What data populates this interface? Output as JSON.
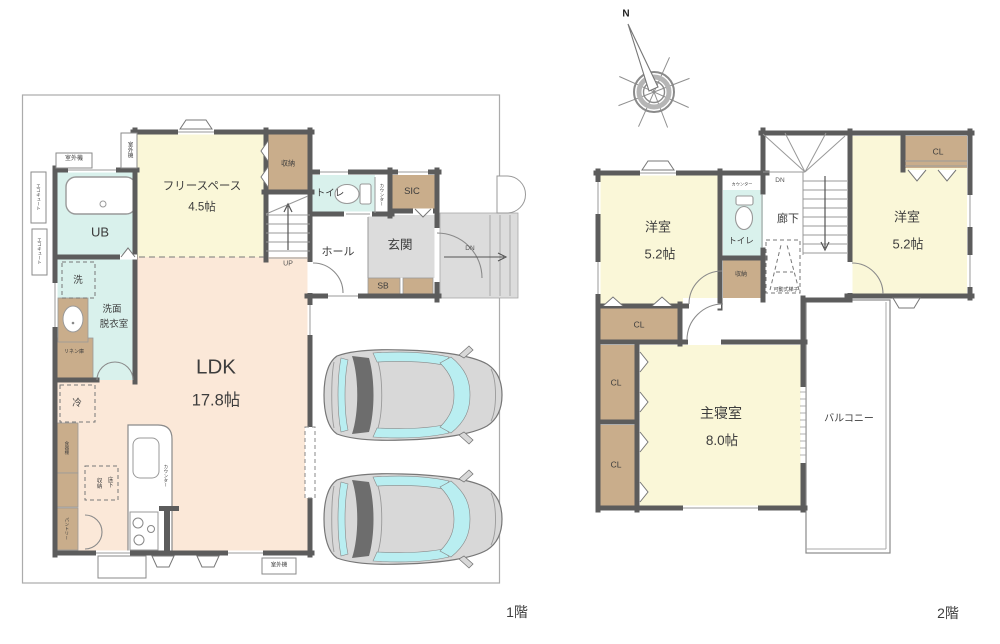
{
  "compass": {
    "north": "N"
  },
  "colors": {
    "wall": "#5c5c5c",
    "room_yellow": "#faf7d8",
    "room_peach": "#fbe8d8",
    "room_cyan": "#d9f1ec",
    "closet_tan": "#c9ad8b",
    "floor_gray": "#dcdcdc",
    "car_body": "#d8d8d8",
    "car_glass": "#b9eef1",
    "car_dark": "#6d6d6d"
  },
  "floor1": {
    "floor_label": "1階",
    "rooms": {
      "ldk": {
        "name": "LDK",
        "size": "17.8帖"
      },
      "free_space": {
        "name": "フリースペース",
        "size": "4.5帖"
      },
      "ub": "UB",
      "washroom_line1": "洗面",
      "washroom_line2": "脱衣室",
      "toilet": "トイレ",
      "sic": "SIC",
      "hall": "ホール",
      "entrance": "玄関",
      "sb": "SB",
      "closet": "収納"
    },
    "labels": {
      "up": "UP",
      "dn": "DN",
      "washer": "洗",
      "fridge": "冷",
      "linen": "リネン庫",
      "cupboard": "食器棚",
      "pantry": "パントリー",
      "underfloor_col1": "床下",
      "underfloor_col2": "収納",
      "counter": "カウンター",
      "outdoor_unit": "室外機",
      "ecocute": "エコキュート"
    }
  },
  "floor2": {
    "floor_label": "2階",
    "rooms": {
      "west_bedroom": {
        "name": "洋室",
        "size": "5.2帖"
      },
      "east_bedroom": {
        "name": "洋室",
        "size": "5.2帖"
      },
      "master_bedroom": {
        "name": "主寝室",
        "size": "8.0帖"
      },
      "toilet": "トイレ",
      "hallway": "廊下",
      "closet": "収納",
      "balcony": "バルコニー",
      "cl": "CL"
    },
    "labels": {
      "dn": "DN",
      "counter": "カウンター",
      "ladder": "可動式梯子"
    }
  }
}
